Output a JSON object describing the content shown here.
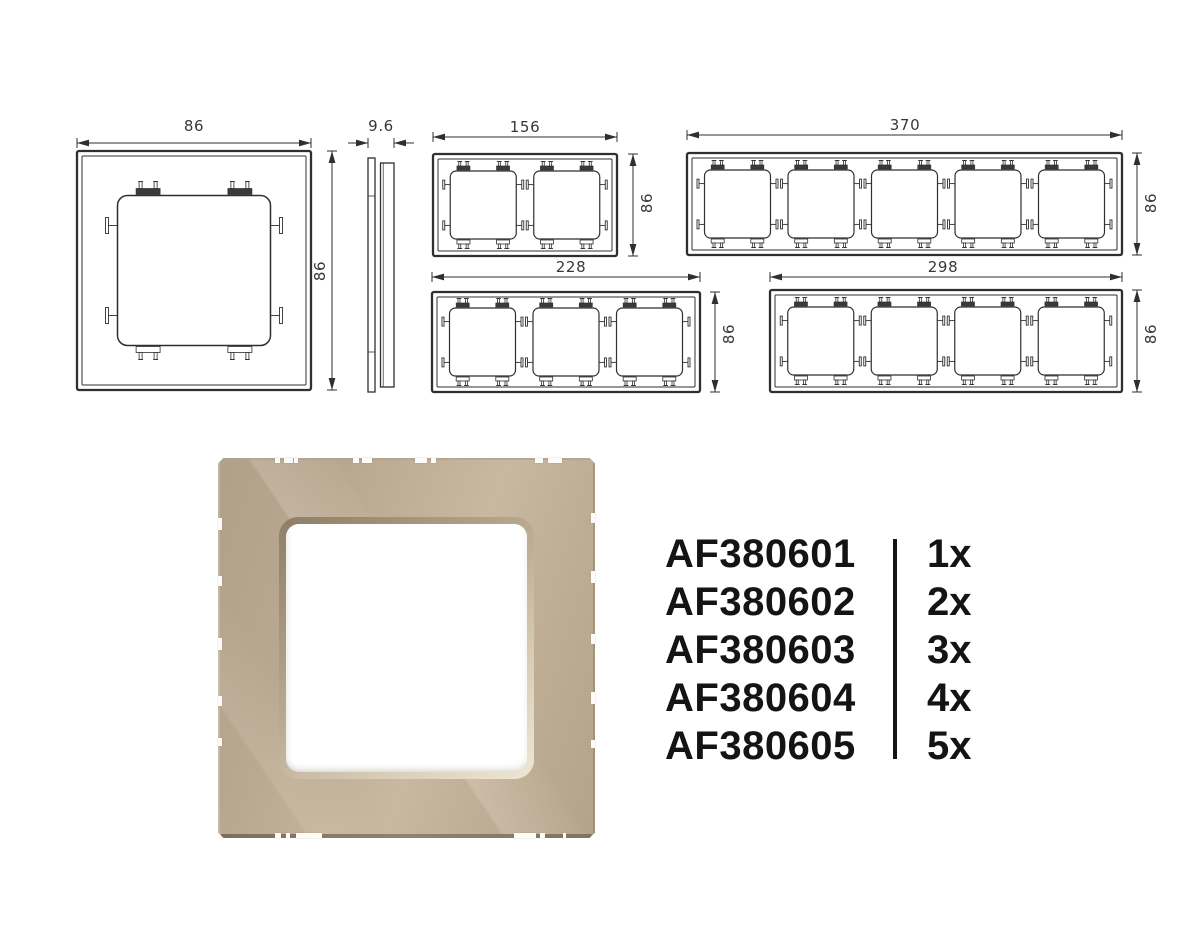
{
  "colors": {
    "drawing_line": "#2f2f2f",
    "dimension_text": "#383838",
    "glass_base": "#bcab93",
    "glass_light": "#c9b8a0",
    "glass_dark": "#b1a089",
    "glass_edge_dark": "#84735d",
    "list_text": "#141414"
  },
  "drawings": {
    "front1": {
      "gangs": 1,
      "width_label": "86",
      "height_label": "86"
    },
    "side": {
      "depth_label": "9.6"
    },
    "front2": {
      "gangs": 2,
      "width_label": "156",
      "height_label": "86"
    },
    "front3": {
      "gangs": 3,
      "width_label": "228",
      "height_label": "86"
    },
    "front4": {
      "gangs": 4,
      "width_label": "298",
      "height_label": "86"
    },
    "front5": {
      "gangs": 5,
      "width_label": "370",
      "height_label": "86"
    }
  },
  "order_list": {
    "items": [
      {
        "code": "AF380601",
        "qty": "1x"
      },
      {
        "code": "AF380602",
        "qty": "2x"
      },
      {
        "code": "AF380603",
        "qty": "3x"
      },
      {
        "code": "AF380604",
        "qty": "4x"
      },
      {
        "code": "AF380605",
        "qty": "5x"
      }
    ]
  }
}
